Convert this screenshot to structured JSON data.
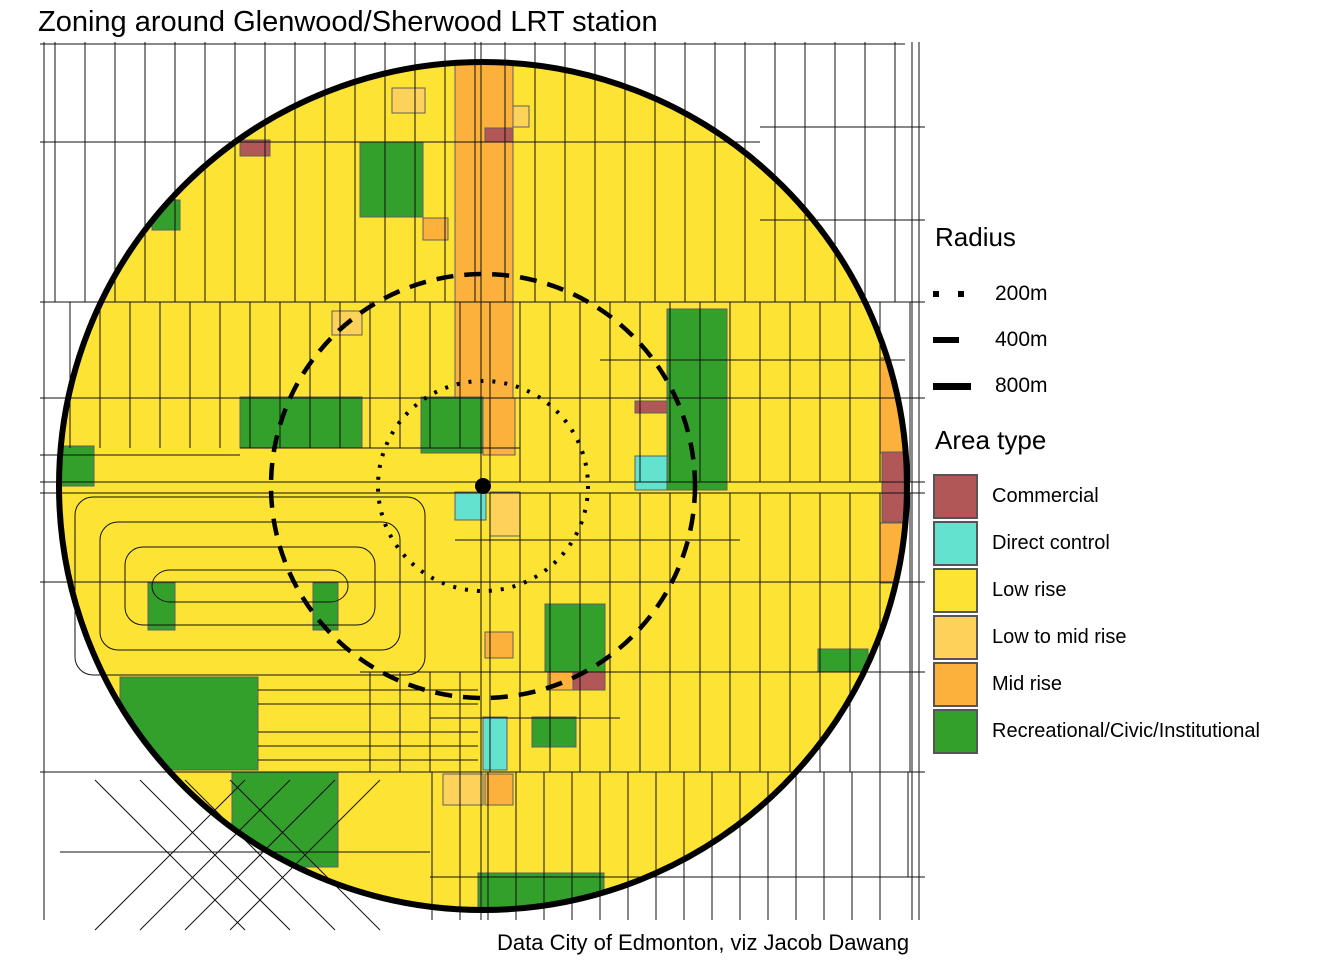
{
  "title": "Zoning around Glenwood/Sherwood LRT station",
  "caption": "Data City of Edmonton, viz Jacob Dawang",
  "legend": {
    "radius_title": "Radius",
    "radius_items": [
      {
        "label": "200m",
        "style": "dotted"
      },
      {
        "label": "400m",
        "style": "dashed"
      },
      {
        "label": "800m",
        "style": "solid"
      }
    ],
    "area_title": "Area type",
    "area_items": [
      {
        "label": "Commercial",
        "key": "commercial",
        "color": "#b25757"
      },
      {
        "label": "Direct control",
        "key": "direct_control",
        "color": "#63e2d0"
      },
      {
        "label": "Low rise",
        "key": "low_rise",
        "color": "#fde333"
      },
      {
        "label": "Low to mid rise",
        "key": "low_to_mid_rise",
        "color": "#fdd25a"
      },
      {
        "label": "Mid rise",
        "key": "mid_rise",
        "color": "#fcb13c"
      },
      {
        "label": "Recreational/Civic/Institutional",
        "key": "recreational",
        "color": "#33a02c"
      }
    ]
  },
  "map": {
    "station": {
      "name": "Glenwood/Sherwood LRT station",
      "x": 483,
      "y": 486,
      "dot_radius": 8
    },
    "base_area_type": "low_rise",
    "radius_circles": [
      {
        "label": "200m",
        "r": 105,
        "dash": "3 9",
        "width": 4
      },
      {
        "label": "400m",
        "r": 212,
        "dash": "17 11",
        "width": 4.5
      },
      {
        "label": "800m",
        "r": 424,
        "dash": "",
        "width": 6
      }
    ],
    "zones": [
      {
        "type": "mid_rise",
        "x": 455,
        "y": 58,
        "w": 58,
        "h": 340
      },
      {
        "type": "mid_rise",
        "x": 483,
        "y": 398,
        "w": 32,
        "h": 57
      },
      {
        "type": "mid_rise",
        "x": 423,
        "y": 218,
        "w": 25,
        "h": 22
      },
      {
        "type": "mid_rise",
        "x": 880,
        "y": 358,
        "w": 26,
        "h": 95
      },
      {
        "type": "mid_rise",
        "x": 880,
        "y": 523,
        "w": 24,
        "h": 60
      },
      {
        "type": "mid_rise",
        "x": 485,
        "y": 774,
        "w": 28,
        "h": 31
      },
      {
        "type": "mid_rise",
        "x": 485,
        "y": 632,
        "w": 28,
        "h": 26
      },
      {
        "type": "mid_rise",
        "x": 548,
        "y": 671,
        "w": 26,
        "h": 19
      },
      {
        "type": "low_to_mid_rise",
        "x": 392,
        "y": 88,
        "w": 33,
        "h": 25
      },
      {
        "type": "low_to_mid_rise",
        "x": 513,
        "y": 106,
        "w": 16,
        "h": 21
      },
      {
        "type": "low_to_mid_rise",
        "x": 332,
        "y": 311,
        "w": 30,
        "h": 24
      },
      {
        "type": "low_to_mid_rise",
        "x": 490,
        "y": 492,
        "w": 30,
        "h": 44
      },
      {
        "type": "low_to_mid_rise",
        "x": 443,
        "y": 774,
        "w": 40,
        "h": 31
      },
      {
        "type": "commercial",
        "x": 240,
        "y": 140,
        "w": 30,
        "h": 16
      },
      {
        "type": "commercial",
        "x": 485,
        "y": 128,
        "w": 28,
        "h": 14
      },
      {
        "type": "commercial",
        "x": 635,
        "y": 401,
        "w": 32,
        "h": 12
      },
      {
        "type": "commercial",
        "x": 882,
        "y": 452,
        "w": 22,
        "h": 70
      },
      {
        "type": "commercial",
        "x": 573,
        "y": 671,
        "w": 32,
        "h": 19
      },
      {
        "type": "direct_control",
        "x": 635,
        "y": 456,
        "w": 32,
        "h": 34
      },
      {
        "type": "direct_control",
        "x": 455,
        "y": 492,
        "w": 31,
        "h": 28
      },
      {
        "type": "direct_control",
        "x": 483,
        "y": 717,
        "w": 24,
        "h": 53
      },
      {
        "type": "recreational",
        "x": 360,
        "y": 142,
        "w": 63,
        "h": 75
      },
      {
        "type": "recreational",
        "x": 152,
        "y": 200,
        "w": 28,
        "h": 30
      },
      {
        "type": "recreational",
        "x": 421,
        "y": 397,
        "w": 62,
        "h": 56
      },
      {
        "type": "recreational",
        "x": 240,
        "y": 397,
        "w": 122,
        "h": 51
      },
      {
        "type": "recreational",
        "x": 60,
        "y": 446,
        "w": 34,
        "h": 40
      },
      {
        "type": "recreational",
        "x": 667,
        "y": 309,
        "w": 60,
        "h": 181
      },
      {
        "type": "recreational",
        "x": 148,
        "y": 583,
        "w": 27,
        "h": 47
      },
      {
        "type": "recreational",
        "x": 313,
        "y": 583,
        "w": 25,
        "h": 47
      },
      {
        "type": "recreational",
        "x": 545,
        "y": 604,
        "w": 60,
        "h": 68
      },
      {
        "type": "recreational",
        "x": 120,
        "y": 677,
        "w": 138,
        "h": 93
      },
      {
        "type": "recreational",
        "x": 232,
        "y": 772,
        "w": 106,
        "h": 95
      },
      {
        "type": "recreational",
        "x": 532,
        "y": 717,
        "w": 44,
        "h": 30
      },
      {
        "type": "recreational",
        "x": 478,
        "y": 873,
        "w": 126,
        "h": 34
      },
      {
        "type": "recreational",
        "x": 818,
        "y": 649,
        "w": 50,
        "h": 23
      }
    ],
    "street_grid": {
      "vbands": [
        {
          "x1": 55,
          "x2": 905,
          "step": 30,
          "y1": 42,
          "y2": 302
        },
        {
          "x1": 70,
          "x2": 910,
          "step": 30,
          "y1": 302,
          "y2": 398
        },
        {
          "x1": 70,
          "x2": 460,
          "step": 30,
          "y1": 398,
          "y2": 448
        },
        {
          "x1": 490,
          "x2": 910,
          "step": 30,
          "y1": 398,
          "y2": 482
        },
        {
          "x1": 490,
          "x2": 910,
          "step": 30,
          "y1": 493,
          "y2": 582
        },
        {
          "x1": 490,
          "x2": 910,
          "step": 30,
          "y1": 582,
          "y2": 672
        },
        {
          "x1": 370,
          "x2": 910,
          "step": 30,
          "y1": 672,
          "y2": 772
        },
        {
          "x1": 432,
          "x2": 910,
          "step": 28,
          "y1": 772,
          "y2": 877
        },
        {
          "x1": 432,
          "x2": 904,
          "step": 28,
          "y1": 877,
          "y2": 920
        },
        {
          "x1": 481,
          "x2": 481,
          "step": 1,
          "y1": 42,
          "y2": 920
        },
        {
          "x1": 44,
          "x2": 44,
          "step": 1,
          "y1": 42,
          "y2": 920
        },
        {
          "x1": 912,
          "x2": 912,
          "step": 1,
          "y1": 42,
          "y2": 920
        },
        {
          "x1": 919,
          "x2": 919,
          "step": 1,
          "y1": 42,
          "y2": 920
        }
      ],
      "horizontals": [
        {
          "y": 44,
          "x1": 40,
          "x2": 905
        },
        {
          "y": 127,
          "x1": 760,
          "x2": 925
        },
        {
          "y": 142,
          "x1": 40,
          "x2": 760
        },
        {
          "y": 220,
          "x1": 760,
          "x2": 925
        },
        {
          "y": 302,
          "x1": 40,
          "x2": 925
        },
        {
          "y": 360,
          "x1": 600,
          "x2": 905
        },
        {
          "y": 398,
          "x1": 40,
          "x2": 925
        },
        {
          "y": 448,
          "x1": 240,
          "x2": 520
        },
        {
          "y": 455,
          "x1": 40,
          "x2": 240
        },
        {
          "y": 482,
          "x1": 40,
          "x2": 925
        },
        {
          "y": 493,
          "x1": 40,
          "x2": 925
        },
        {
          "y": 540,
          "x1": 455,
          "x2": 740
        },
        {
          "y": 582,
          "x1": 40,
          "x2": 925
        },
        {
          "y": 672,
          "x1": 360,
          "x2": 925
        },
        {
          "y": 690,
          "x1": 258,
          "x2": 478
        },
        {
          "y": 704,
          "x1": 258,
          "x2": 478
        },
        {
          "y": 718,
          "x1": 430,
          "x2": 620
        },
        {
          "y": 732,
          "x1": 258,
          "x2": 478
        },
        {
          "y": 746,
          "x1": 258,
          "x2": 478
        },
        {
          "y": 760,
          "x1": 258,
          "x2": 478
        },
        {
          "y": 772,
          "x1": 40,
          "x2": 925
        },
        {
          "y": 852,
          "x1": 60,
          "x2": 430
        },
        {
          "y": 877,
          "x1": 430,
          "x2": 925
        }
      ],
      "diagonals": [
        [
          95,
          930,
          245,
          780
        ],
        [
          140,
          930,
          290,
          780
        ],
        [
          185,
          930,
          335,
          780
        ],
        [
          230,
          930,
          380,
          780
        ],
        [
          95,
          780,
          245,
          930
        ],
        [
          140,
          780,
          290,
          930
        ],
        [
          185,
          780,
          335,
          930
        ],
        [
          230,
          780,
          380,
          930
        ]
      ],
      "loops": [
        [
          75,
          497,
          350,
          178
        ],
        [
          100,
          522,
          300,
          128
        ],
        [
          125,
          547,
          250,
          78
        ],
        [
          152,
          570,
          196,
          32
        ]
      ]
    }
  }
}
